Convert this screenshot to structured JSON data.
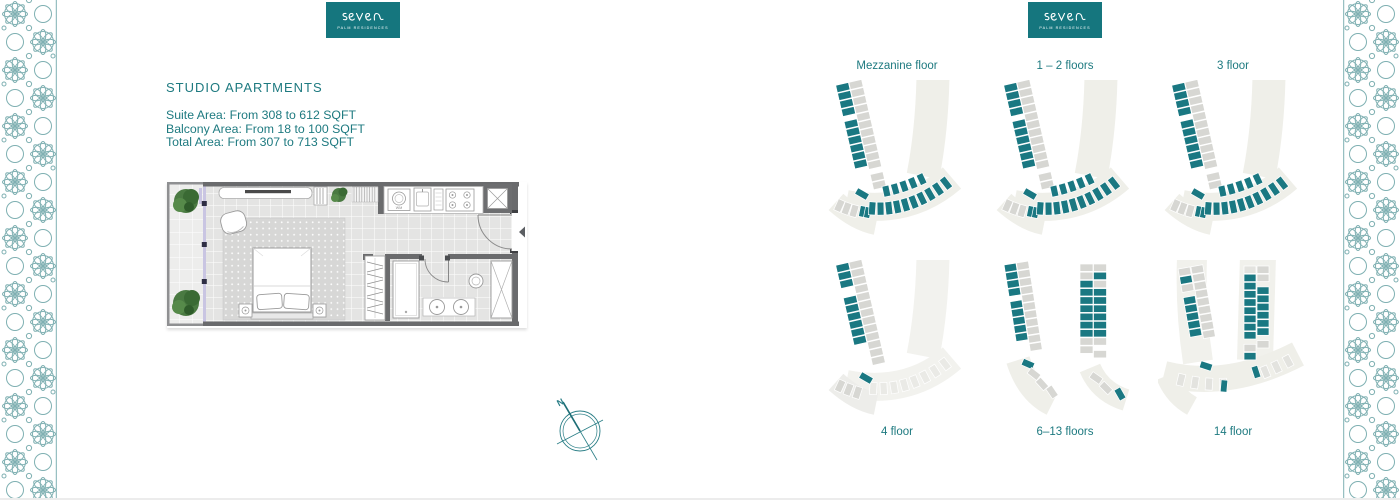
{
  "colors": {
    "teal_text": "#1e7a80",
    "logo_bg": "#15767e",
    "plan_teal": "#1a7882",
    "plan_gray": "#d7d7d3",
    "plan_gray_light": "#e3e3df",
    "plan_ivory": "#efefe9",
    "plan_ivory_faint": "#f2f2ee",
    "wall": "#6a6b6d",
    "ornament": "#7fb0b2",
    "glass": "#c9c5e2",
    "plant": "#4a7a42"
  },
  "brand": {
    "name": "seven",
    "tagline": "PALM RESIDENCES"
  },
  "left_panel": {
    "title": "STUDIO APARTMENTS",
    "area_lines": [
      "Suite Area: From 308 to 612 SQFT",
      "Balcony Area: From 18 to 100 SQFT",
      "Total Area: From 307 to 713 SQFT"
    ]
  },
  "floor_plan": {
    "washer_label": "WM"
  },
  "compass": {
    "north_label": "N"
  },
  "key_plans": [
    {
      "label": "Mezzanine floor",
      "variant": "full"
    },
    {
      "label": "1 – 2 floors",
      "variant": "full"
    },
    {
      "label": "3 floor",
      "variant": "full"
    },
    {
      "label": "4 floor",
      "variant": "wing"
    },
    {
      "label": "6–13 floors",
      "variant": "strips"
    },
    {
      "label": "14 floor",
      "variant": "strips-arc"
    }
  ]
}
